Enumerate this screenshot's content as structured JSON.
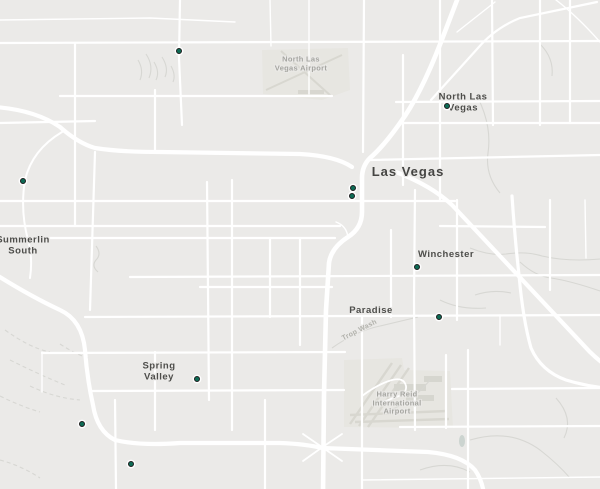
{
  "map": {
    "colors": {
      "background": "#ebeae8",
      "road": "#ffffff",
      "airport_ground": "#e7e6e1",
      "runway": "#d8d7d0",
      "wash_line": "#d7d7d3",
      "city_label": "#4d4d4a",
      "poi_label": "#a5a5a0",
      "marker_fill": "#0e6b55",
      "marker_ring": "#1d1d1d"
    },
    "city_labels": [
      {
        "name": "north-las-vegas",
        "lines": [
          "North Las",
          "Vegas"
        ],
        "x": 463,
        "y": 103,
        "size": "normal"
      },
      {
        "name": "las-vegas",
        "lines": [
          "Las Vegas"
        ],
        "x": 408,
        "y": 172,
        "size": "large"
      },
      {
        "name": "summerlin-south",
        "lines": [
          "Summerlin",
          "South"
        ],
        "x": 23,
        "y": 246,
        "size": "normal"
      },
      {
        "name": "winchester",
        "lines": [
          "Winchester"
        ],
        "x": 446,
        "y": 255,
        "size": "normal"
      },
      {
        "name": "paradise",
        "lines": [
          "Paradise"
        ],
        "x": 371,
        "y": 311,
        "size": "normal"
      },
      {
        "name": "spring-valley",
        "lines": [
          "Spring",
          "Valley"
        ],
        "x": 159,
        "y": 372,
        "size": "normal"
      }
    ],
    "poi_labels": [
      {
        "name": "north-las-vegas-airport",
        "lines": [
          "North Las",
          "Vegas Airport"
        ],
        "x": 301,
        "y": 64,
        "rotate": 0
      },
      {
        "name": "harry-reid-international-airport",
        "lines": [
          "Harry Reid",
          "International",
          "Airport"
        ],
        "x": 397,
        "y": 403,
        "rotate": 0
      },
      {
        "name": "trop-wash",
        "lines": [
          "Trop Wash"
        ],
        "x": 360,
        "y": 331,
        "rotate": -27
      }
    ],
    "markers": [
      {
        "x": 179,
        "y": 51
      },
      {
        "x": 447,
        "y": 106
      },
      {
        "x": 23,
        "y": 181
      },
      {
        "x": 353,
        "y": 188
      },
      {
        "x": 352,
        "y": 196
      },
      {
        "x": 417,
        "y": 267
      },
      {
        "x": 439,
        "y": 317
      },
      {
        "x": 197,
        "y": 379
      },
      {
        "x": 82,
        "y": 424
      },
      {
        "x": 131,
        "y": 464
      }
    ]
  }
}
